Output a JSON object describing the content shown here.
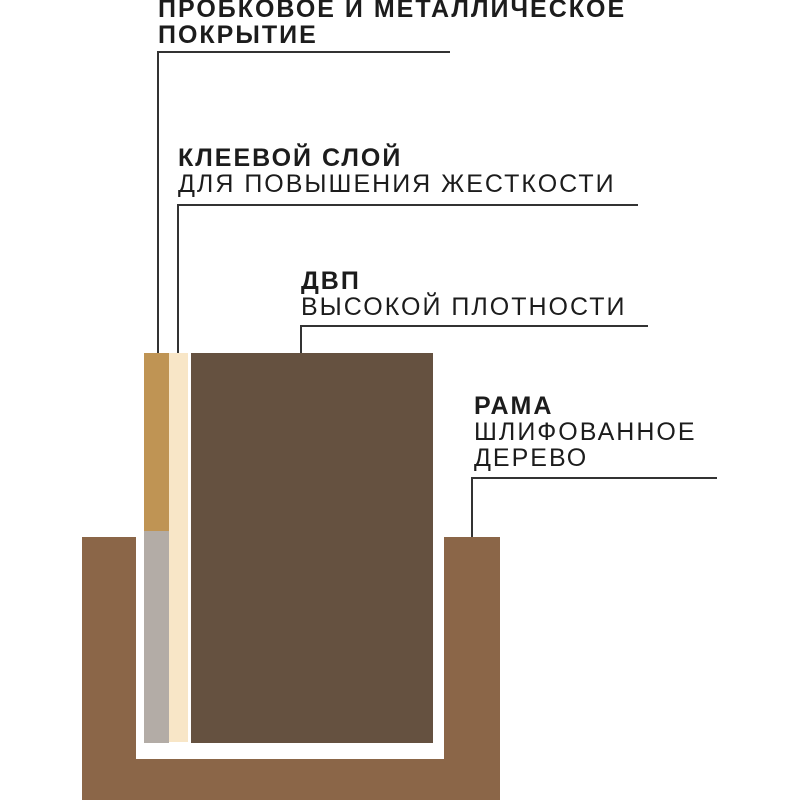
{
  "labels": [
    {
      "id": "cork-metal-coating",
      "line1": "ПРОБКОВОЕ И МЕТАЛЛИЧЕСКОЕ",
      "line2": "ПОКРЫТИЕ"
    },
    {
      "id": "glue-layer",
      "line1": "КЛЕЕВОЙ СЛОЙ",
      "line2": "ДЛЯ ПОВЫШЕНИЯ ЖЕСТКОСТИ"
    },
    {
      "id": "hdf-board",
      "line1": "ДВП",
      "line2": "ВЫСОКОЙ ПЛОТНОСТИ"
    },
    {
      "id": "frame",
      "line1": "РАМА",
      "line2": "ШЛИФОВАННОЕ ДЕРЕВО"
    }
  ],
  "colors": {
    "background": "#FFFFFF",
    "text": "#1C1C1C",
    "line": "#333333",
    "cork": "#BF9454",
    "metal": "#B3ACA6",
    "glue": "#F8E6C7",
    "board": "#655140",
    "frame": "#8B6648"
  }
}
